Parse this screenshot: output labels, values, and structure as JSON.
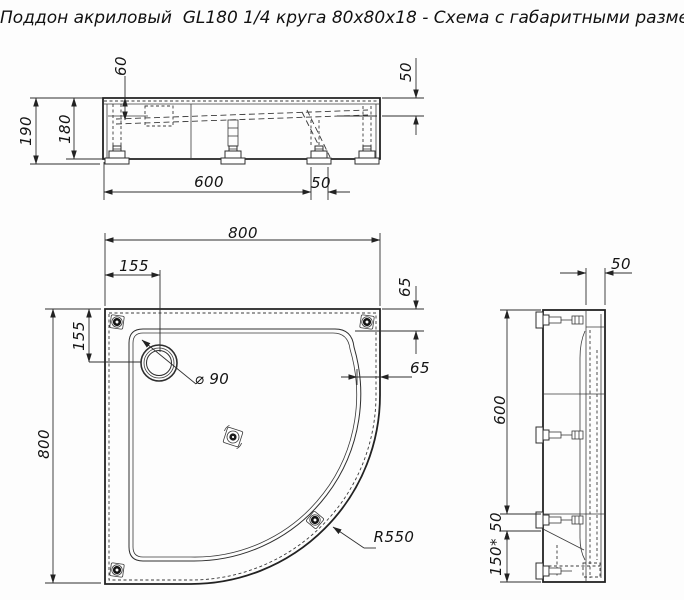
{
  "title": "Поддон акриловый  GL180 1/4 круга 80х80х18 - Схема с габаритными размерами",
  "front_view": {
    "dim_basin_depth": "60",
    "dim_rim_drop": "50",
    "dim_total_height": "190",
    "dim_body_height": "180",
    "dim_feet_span": "600",
    "dim_foot_plate": "50"
  },
  "plan_view": {
    "dim_width": "800",
    "dim_height": "800",
    "dim_drain_offset_top": "155",
    "dim_drain_offset_left": "155",
    "dim_rim_top": "65",
    "dim_rim_right": "65",
    "drain_diameter": "⌀ 90",
    "corner_radius": "R550"
  },
  "side_view": {
    "dim_rim_width": "50",
    "dim_span": "600",
    "dim_foot_plate": "50",
    "dim_bottom_offset": "150*"
  }
}
